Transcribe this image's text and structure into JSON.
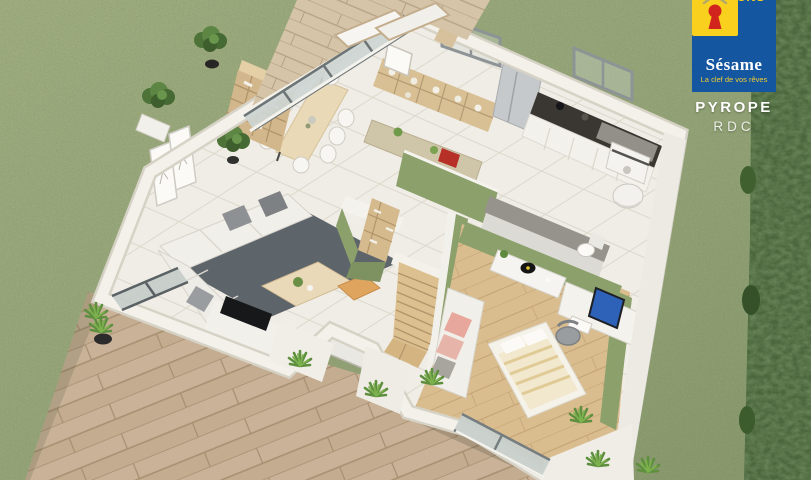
{
  "brand": {
    "top_text": "MAISONS",
    "name": "Sésame",
    "tagline": "La clef de vos rêves",
    "logo_blue": "#1456a0",
    "logo_yellow": "#f8d01d",
    "logo_red": "#d0241c"
  },
  "project": {
    "name": "PYROPE",
    "floor": "RDC"
  },
  "scene": {
    "type": "isometric 3D floor-plan render of a single-storey house, ground floor",
    "rooms": [
      {
        "name": "living-dining-room",
        "contents": [
          "L-shaped white sofa",
          "dark grey rug",
          "wooden coffee table",
          "orange pouf",
          "wall TV",
          "dining table with white chairs",
          "tall bookcase",
          "low cubby sideboard with vases",
          "two framed prints",
          "potted plant"
        ]
      },
      {
        "name": "kitchen",
        "contents": [
          "dark worktop",
          "white base cabinets",
          "stainless fridge",
          "cooktop",
          "two windows"
        ]
      },
      {
        "name": "hallway",
        "contents": [
          "wooden staircase",
          "olive partition wall",
          "bar counter with red toy"
        ]
      },
      {
        "name": "utility-room",
        "contents": [
          "washing machine",
          "round water heater"
        ]
      },
      {
        "name": "bathroom",
        "contents": [
          "toilet",
          "white vanity"
        ]
      },
      {
        "name": "bedroom-office",
        "contents": [
          "bed with striped duvet",
          "white daybed with pink cushions",
          "corner desk with monitor and record player",
          "office chair",
          "sliding glass door"
        ]
      },
      {
        "name": "entrance-porch",
        "contents": [
          "front door"
        ]
      }
    ],
    "exterior": [
      "front timber deck",
      "rear terrace deck with sun loungers",
      "lawn",
      "clipped hedge along right edge",
      "shrubs and grass tufts along the walls"
    ]
  },
  "palette": {
    "grass": "#93a377",
    "hedge": "#4b663c",
    "deck_wood": "#c9b298",
    "floor_tile": "#f0ede6",
    "floor_wood": "#d9bd8f",
    "wall": "#f2f0e9",
    "accent_olive": "#8ba06b",
    "rug": "#5d646a",
    "counter": "#3a3733"
  }
}
